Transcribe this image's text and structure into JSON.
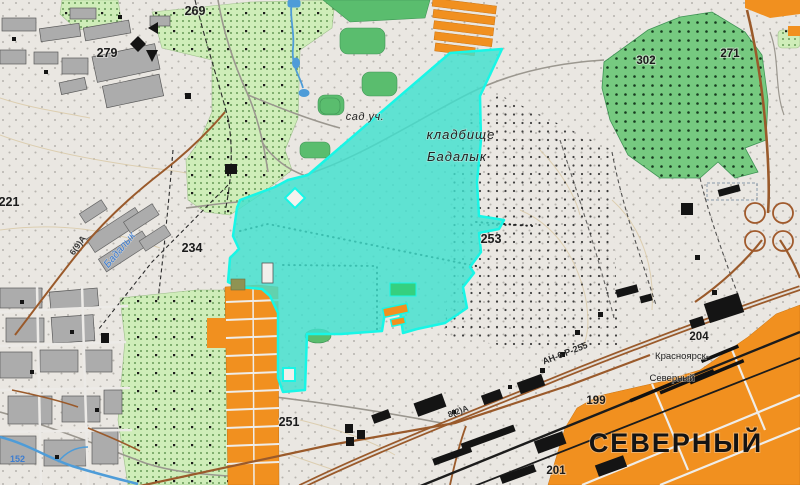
{
  "map": {
    "labels": {
      "district_big": "СЕВЕРНЫЙ",
      "cemetery_line1": "кладбище",
      "cemetery_line2": "Бадалык",
      "garden_plots": "сад уч.",
      "station_line1": "Красноярск-",
      "station_line2": "Северный",
      "river_name": "Бадалык",
      "water_level_mark": "152"
    },
    "elevations": {
      "e269": "269",
      "e279": "279",
      "e221": "221",
      "e234": "234",
      "e253": "253",
      "e251": "251",
      "e302": "302",
      "e271": "271",
      "e204": "204",
      "e199": "199",
      "e201": "201"
    },
    "road_labels": {
      "highway": "АН-6 Р-255",
      "road_secondary": "8(2)А",
      "road_west": "6(9)А"
    },
    "colors": {
      "paper": "#EAE7E2",
      "orchard_green": "#CFEDB9",
      "forest_green": "#5ABD6E",
      "forest_dotted_green": "#76CA80",
      "urban_orange": "#F1901F",
      "building_gray": "#ACACAC",
      "building_black": "#141414",
      "road_brown": "#9A5A2B",
      "water_blue": "#4E9CD8",
      "highlight_cyan": "#41E1CE",
      "highlight_border": "#18F6E6"
    }
  }
}
